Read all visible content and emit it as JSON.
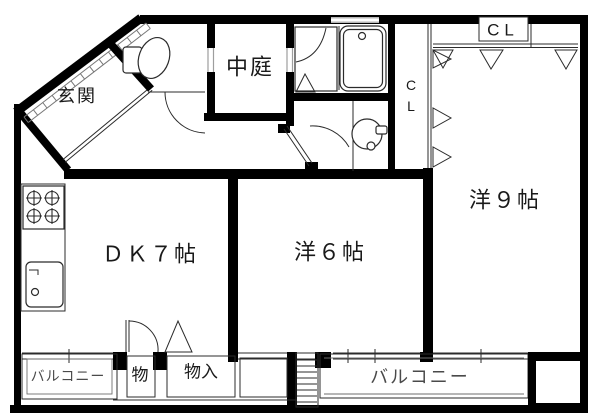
{
  "rooms": {
    "genkan": "玄関",
    "courtyard": "中庭",
    "dk": "ＤＫ７帖",
    "western6": "洋６帖",
    "western9": "洋９帖"
  },
  "closets": {
    "top": "CL",
    "side_c": "C",
    "side_l": "L",
    "storage": "物",
    "storage_in": "物入"
  },
  "balconies": {
    "left": "バルコニー",
    "center": "バルコニー"
  },
  "colors": {
    "wall": "#000000",
    "thin_line": "#2b2b2b",
    "window_gray": "#9e9e9e",
    "balcony_text": "#4a4a4a"
  }
}
